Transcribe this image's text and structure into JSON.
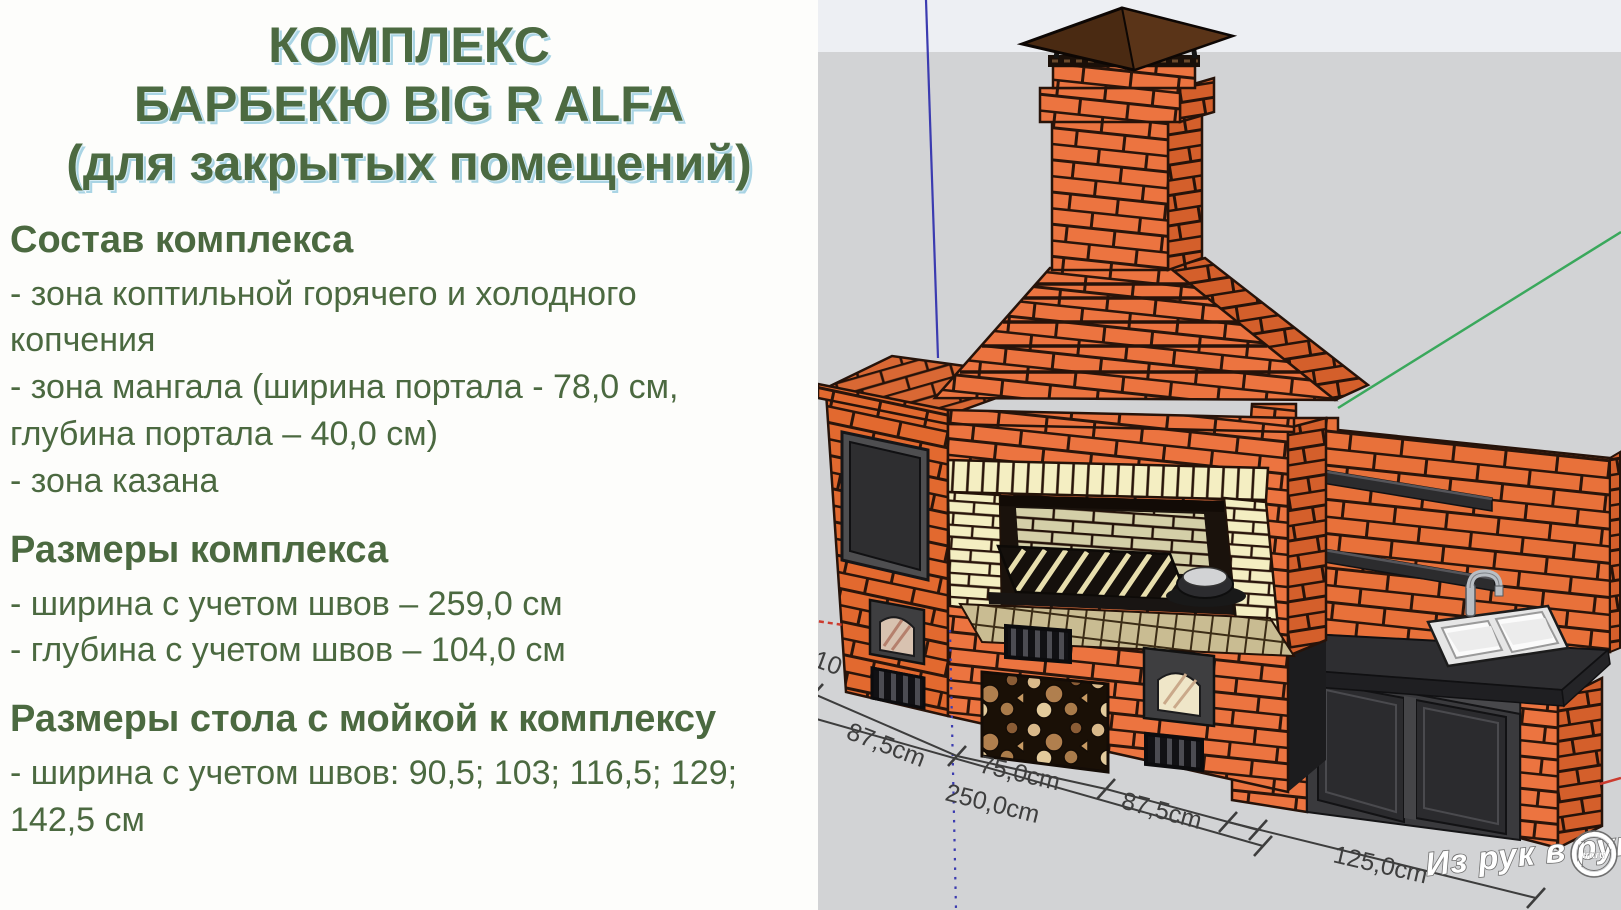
{
  "title": {
    "line1": "КОМПЛЕКС",
    "line2": "БАРБЕКЮ BIG R ALFA",
    "line3": "(для закрытых помещений)"
  },
  "sections": [
    {
      "heading": "Состав комплекса",
      "items": [
        "- зона коптильной горячего и холодного копчения",
        "- зона мангала (ширина портала - 78,0 см, глубина портала – 40,0 см)",
        "- зона казана"
      ]
    },
    {
      "heading": "Размеры комплекса",
      "items": [
        "- ширина с учетом швов – 259,0 см",
        "- глубина с учетом швов – 104,0 см"
      ]
    },
    {
      "heading": "Размеры стола с мойкой к комплексу",
      "items": [
        "- ширина с учетом швов: 90,5; 103; 116,5; 129; 142,5 см"
      ]
    }
  ],
  "drawing": {
    "dimension_labels": {
      "left_width": "87,5cm",
      "center_width": "75,0cm",
      "total_width": "250,0cm",
      "right_width": "87,5cm",
      "table_width": "125,0cm",
      "partial_left": "10"
    },
    "watermark": {
      "text": "Из рук в руки",
      "logo": "irr.ru"
    },
    "colors": {
      "brick": "#ec7440",
      "firebrick": "#f4eec2",
      "background_gray": "#d2d3d5",
      "background_top": "#edeff3",
      "axis_blue": "#3b3bb0",
      "axis_green": "#3aa85c",
      "axis_red": "#cc3b2f",
      "text_green": "#4b6940",
      "title_shadow": "#a9d4e4"
    }
  }
}
